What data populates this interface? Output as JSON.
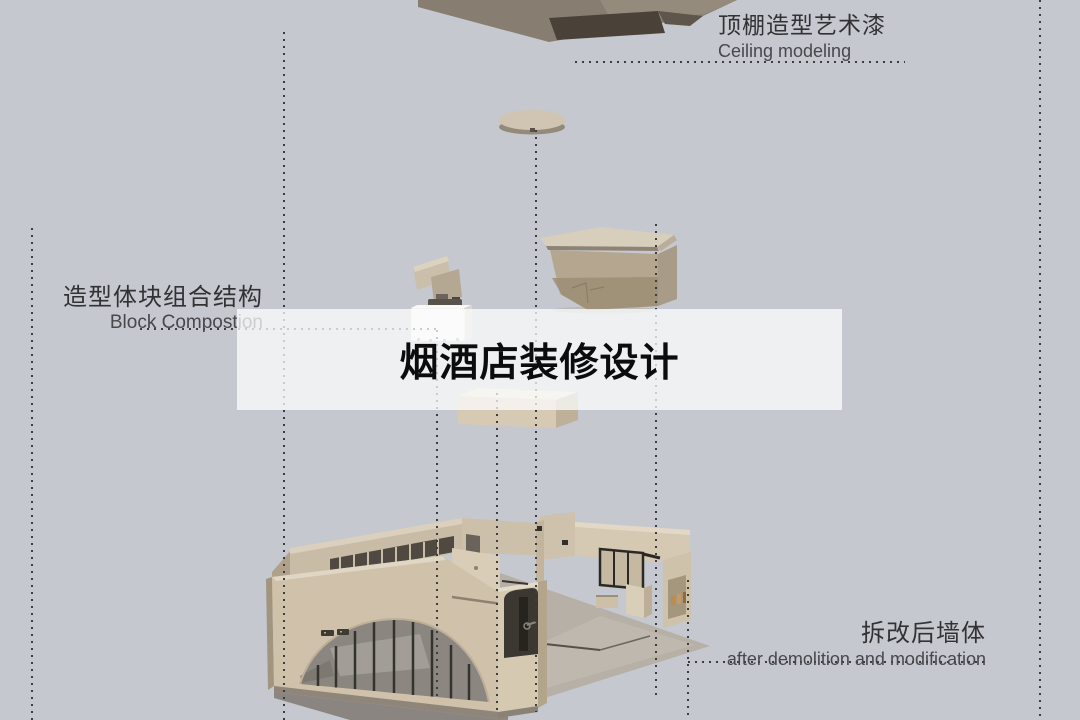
{
  "title": {
    "text": "烟酒店装修设计"
  },
  "labels": {
    "ceiling": {
      "zh": "顶棚造型艺术漆",
      "en": "Ceiling modeling"
    },
    "block": {
      "zh": "造型体块组合结构",
      "en": "Block Compostion"
    },
    "demolition": {
      "zh": "拆改后墙体",
      "en": "after demolition and modification"
    }
  },
  "colors": {
    "background": "#c5c8cf",
    "banner": "rgba(252,253,254,0.74)",
    "leader_dots": "#3d3d40",
    "label_zh_text": "#323235",
    "label_en_text": "#48484c",
    "title_text": "#0c0c0d",
    "wall_beige": "#cfc1aa",
    "ceiling_slab": "#877d70",
    "glazing": "#8b8780"
  }
}
